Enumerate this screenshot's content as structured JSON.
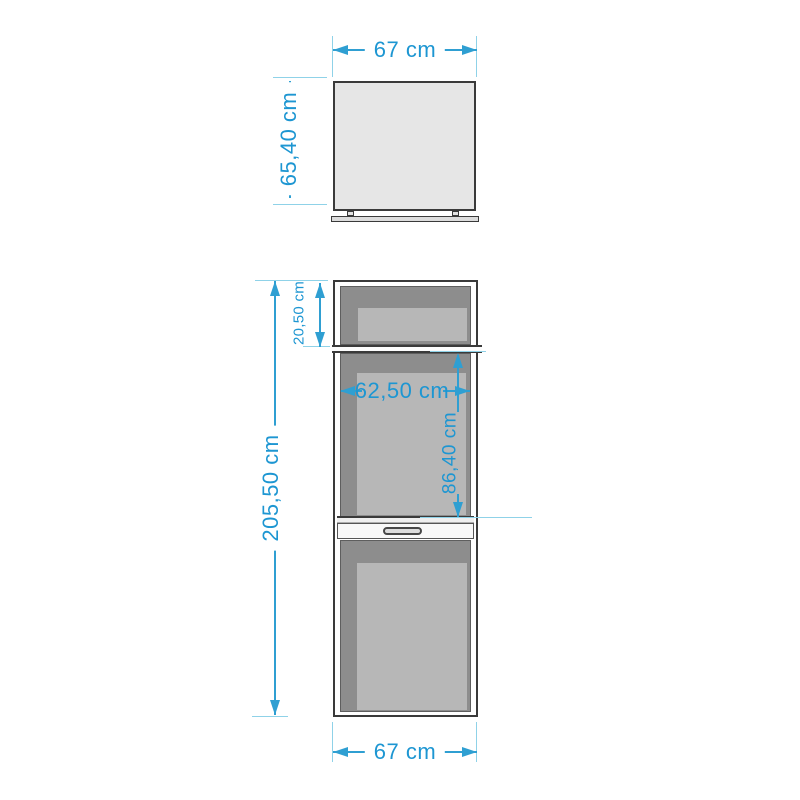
{
  "colors": {
    "line": "#2f9fd2",
    "tick": "#8fd2e8",
    "text": "#1d96d2",
    "outline": "#3a3a3a",
    "cab": "#e6e6e6",
    "rail": "#dcdcdc",
    "dark": "#8d8d8d",
    "light": "#b7b7b7"
  },
  "dims": {
    "upper_width": "67 cm",
    "upper_height": "65,40 cm",
    "total_height": "205,50 cm",
    "top_niche_height": "20,50 cm",
    "niche_width": "62,50 cm",
    "niche_height": "86,40 cm",
    "lower_width": "67 cm"
  }
}
